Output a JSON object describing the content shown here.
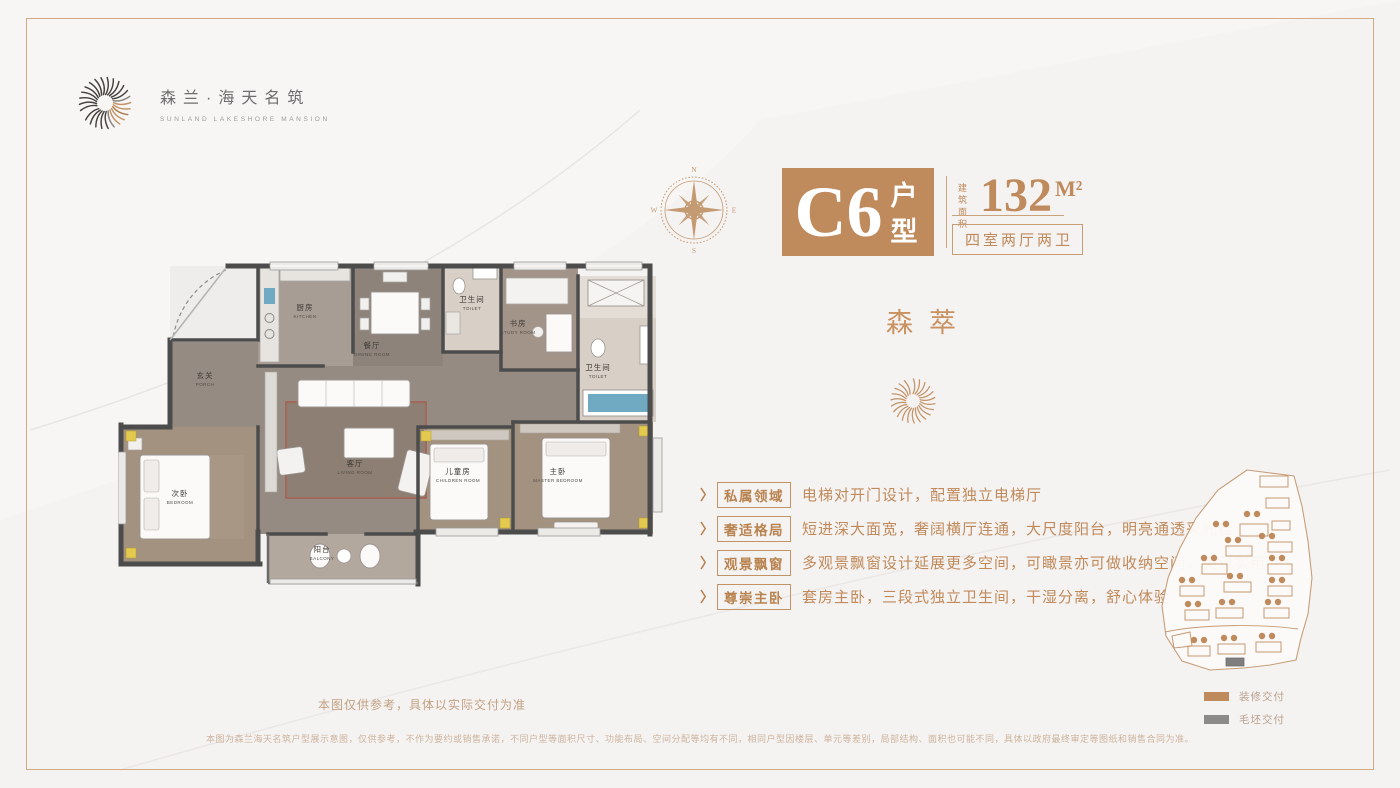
{
  "brand": {
    "name_cn": "森兰·海天名筑",
    "name_en": "SUNLAND LAKESHORE MANSION",
    "logo_icon": "wave-shell-icon"
  },
  "compass": {
    "north": "N",
    "east": "E",
    "south": "S",
    "west": "W"
  },
  "unit": {
    "code": "C6",
    "code_suffix": "户型",
    "area_label": "建筑面积",
    "area_value": "132",
    "area_unit": "M²",
    "layout": "四室两厅两卫"
  },
  "theme": {
    "title": "森萃"
  },
  "features": {
    "chevron": "〉",
    "items": [
      {
        "label": "私属领域",
        "desc": "电梯对开门设计，配置独立电梯厅"
      },
      {
        "label": "奢适格局",
        "desc": "短进深大面宽，奢阔横厅连通，大尺度阳台，明亮通透采光佳"
      },
      {
        "label": "观景飘窗",
        "desc": "多观景飘窗设计延展更多空间，可瞰景亦可做收纳空间，美观实用"
      },
      {
        "label": "尊崇主卧",
        "desc": "套房主卧，三段式独立卫生间，干湿分离，舒心体验"
      }
    ]
  },
  "floorplan": {
    "rooms": [
      {
        "cn": "玄关",
        "en": "PORCH"
      },
      {
        "cn": "厨房",
        "en": "KITCHEN"
      },
      {
        "cn": "餐厅",
        "en": "DINING ROOM"
      },
      {
        "cn": "卫生间",
        "en": "TOILET"
      },
      {
        "cn": "书房",
        "en": "STUDY ROOM"
      },
      {
        "cn": "卫生间",
        "en": "TOILET"
      },
      {
        "cn": "客厅",
        "en": "LIVING ROOM"
      },
      {
        "cn": "次卧",
        "en": "BEDROOM"
      },
      {
        "cn": "儿童房",
        "en": "CHILDREN ROOM"
      },
      {
        "cn": "主卧",
        "en": "MASTER BEDROOM"
      },
      {
        "cn": "阳台",
        "en": "BALCONY"
      }
    ]
  },
  "siteplan": {
    "legend": [
      {
        "label": "装修交付",
        "color": "#bf8a5c"
      },
      {
        "label": "毛坯交付",
        "color": "#8b8b8b"
      }
    ]
  },
  "notes": {
    "reference": "本图仅供参考，具体以实际交付为准",
    "disclaimer": "本图为森兰海天名筑户型展示意图，仅供参考，不作为要约或销售承诺，不同户型等面积尺寸、功能布局、空间分配等均有不同，相同户型因楼层、单元等差别，局部结构、面积也可能不同，具体以政府最终审定等图纸和销售合同为准。"
  },
  "colors": {
    "accent": "#bf8a5c",
    "wall": "#4c4c4c"
  }
}
